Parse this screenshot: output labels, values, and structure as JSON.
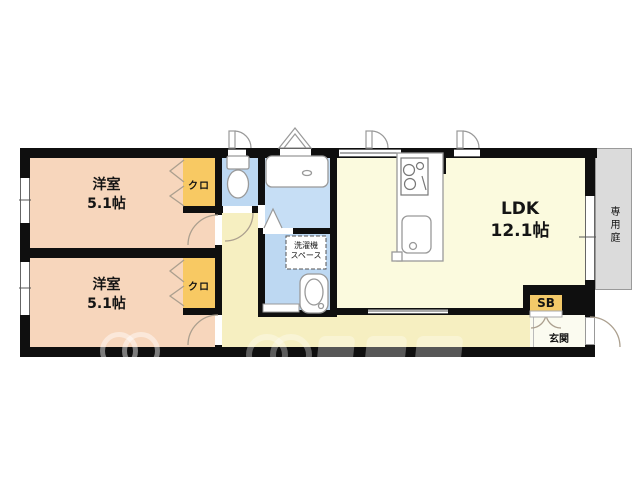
{
  "plan": {
    "bedroom1": {
      "name": "洋室",
      "size": "5.1帖"
    },
    "bedroom2": {
      "name": "洋室",
      "size": "5.1帖"
    },
    "ldk": {
      "name": "LDK",
      "size": "12.1帖"
    },
    "closet1": {
      "label": "クロ"
    },
    "closet2": {
      "label": "クロ"
    },
    "laundry": {
      "line1": "洗濯機",
      "line2": "スペース"
    },
    "shoe_box": {
      "label": "SB"
    },
    "entrance": {
      "label": "玄関"
    },
    "garden": {
      "label": "専用庭"
    }
  },
  "colors": {
    "wall": "#0f0f0f",
    "bedroom_floor": "#f7d6bc",
    "closet_fill": "#f8c963",
    "toilet_bath_fill": "#bdd8f2",
    "washroom_fill": "#c6def5",
    "ldk_floor": "#fbfade",
    "hallway_floor": "#f6efc1",
    "entrance_floor": "#fbfbf0",
    "garden_fill": "#dbdbdb",
    "shoe_box_fill": "#f3c969",
    "fixture_stroke": "#999999",
    "door_arc_stroke": "#ab9f8e"
  }
}
